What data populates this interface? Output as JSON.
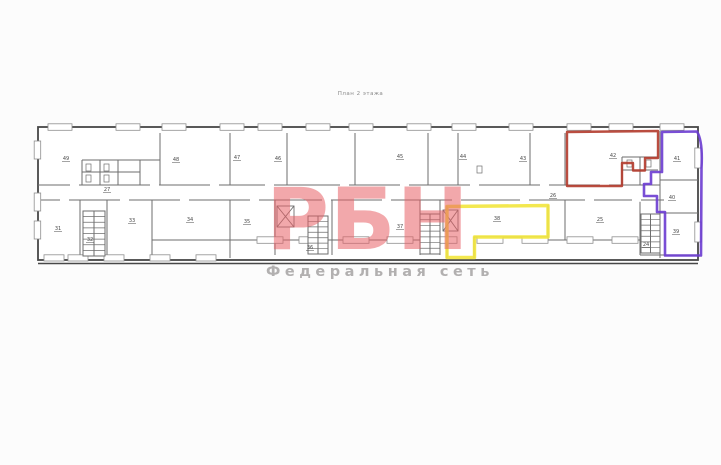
{
  "title": "План 2 этажа",
  "watermark": {
    "logo": "РБН",
    "tagline": "Федеральная сеть",
    "logo_color": "rgba(232,96,102,0.55)",
    "tagline_color": "#b2b0b0"
  },
  "colors": {
    "wall": "#474747",
    "wall_light": "#6e6e6e",
    "red_outline": "#b23a2b",
    "purple_outline": "#6a3bd0",
    "yellow_outline": "#f2e53c",
    "paper": "#ffffff"
  },
  "plan": {
    "room_labels": [
      {
        "t": "49",
        "x": 66,
        "y": 160
      },
      {
        "t": "48",
        "x": 176,
        "y": 161
      },
      {
        "t": "47",
        "x": 237,
        "y": 159
      },
      {
        "t": "46",
        "x": 278,
        "y": 160
      },
      {
        "t": "45",
        "x": 400,
        "y": 158
      },
      {
        "t": "44",
        "x": 463,
        "y": 158
      },
      {
        "t": "43",
        "x": 523,
        "y": 160
      },
      {
        "t": "42",
        "x": 613,
        "y": 157
      },
      {
        "t": "41",
        "x": 677,
        "y": 160
      },
      {
        "t": "40",
        "x": 672,
        "y": 199
      },
      {
        "t": "39",
        "x": 676,
        "y": 233
      },
      {
        "t": "27",
        "x": 107,
        "y": 191
      },
      {
        "t": "26",
        "x": 553,
        "y": 197
      },
      {
        "t": "31",
        "x": 58,
        "y": 230
      },
      {
        "t": "32",
        "x": 90,
        "y": 241
      },
      {
        "t": "33",
        "x": 132,
        "y": 222
      },
      {
        "t": "34",
        "x": 190,
        "y": 221
      },
      {
        "t": "35",
        "x": 247,
        "y": 223
      },
      {
        "t": "36",
        "x": 310,
        "y": 249
      },
      {
        "t": "37",
        "x": 400,
        "y": 228
      },
      {
        "t": "38",
        "x": 497,
        "y": 220
      },
      {
        "t": "25",
        "x": 600,
        "y": 221
      },
      {
        "t": "24",
        "x": 646,
        "y": 246
      }
    ],
    "windows": [
      [
        48,
        123.8,
        24,
        6.5
      ],
      [
        116,
        123.8,
        24,
        6.5
      ],
      [
        162,
        123.8,
        24,
        6.5
      ],
      [
        220,
        123.8,
        24,
        6.5
      ],
      [
        258,
        123.8,
        24,
        6.5
      ],
      [
        306,
        123.8,
        24,
        6.5
      ],
      [
        349,
        123.8,
        24,
        6.5
      ],
      [
        407,
        123.8,
        24,
        6.5
      ],
      [
        452,
        123.8,
        24,
        6.5
      ],
      [
        509,
        123.8,
        24,
        6.5
      ],
      [
        567,
        123.8,
        24,
        6.5
      ],
      [
        609,
        123.8,
        24,
        6.5
      ],
      [
        660,
        123.8,
        24,
        6.5
      ],
      [
        257,
        236.8,
        26,
        6.5
      ],
      [
        299,
        236.8,
        26,
        6.5
      ],
      [
        343,
        236.8,
        26,
        6.5
      ],
      [
        387,
        236.8,
        26,
        6.5
      ],
      [
        431,
        236.8,
        26,
        6.5
      ],
      [
        477,
        236.8,
        26,
        6.5
      ],
      [
        522,
        236.8,
        26,
        6.5
      ],
      [
        567,
        236.8,
        26,
        6.5
      ],
      [
        612,
        236.8,
        26,
        6.5
      ],
      [
        44,
        254.8,
        20,
        6.2
      ],
      [
        68,
        254.8,
        20,
        6.2
      ],
      [
        104,
        254.8,
        20,
        6.2
      ],
      [
        150,
        254.8,
        20,
        6.2
      ],
      [
        196,
        254.8,
        20,
        6.2
      ],
      [
        34.2,
        141,
        6.5,
        18
      ],
      [
        34.2,
        193,
        6.5,
        18
      ],
      [
        34.2,
        221,
        6.5,
        18
      ],
      [
        694.8,
        148,
        6.5,
        20
      ],
      [
        694.8,
        222,
        6.5,
        20
      ]
    ],
    "door_gaps": [
      [
        70,
        183.2
      ],
      [
        150,
        183.2
      ],
      [
        210,
        183.2
      ],
      [
        265,
        183.2
      ],
      [
        340,
        183.2
      ],
      [
        400,
        183.2
      ],
      [
        470,
        183.2
      ],
      [
        540,
        183.2
      ],
      [
        600,
        183.2
      ],
      [
        60,
        198.2
      ],
      [
        120,
        198.2
      ],
      [
        180,
        198.2
      ],
      [
        250,
        198.2
      ],
      [
        322,
        198.2
      ],
      [
        382,
        198.2
      ],
      [
        452,
        198.2
      ],
      [
        520,
        198.2
      ],
      [
        585,
        198.2
      ],
      [
        632,
        198.2
      ]
    ],
    "stairs": [
      {
        "x": 83,
        "y": 211,
        "w": 22,
        "h": 45,
        "n": 8
      },
      {
        "x": 308,
        "y": 216,
        "w": 20,
        "h": 38,
        "n": 7
      },
      {
        "x": 420,
        "y": 214,
        "w": 20,
        "h": 40,
        "n": 7
      },
      {
        "x": 641,
        "y": 214,
        "w": 19,
        "h": 39,
        "n": 7
      }
    ],
    "elevators": [
      {
        "x": 277,
        "y": 206,
        "w": 17,
        "h": 21
      },
      {
        "x": 443,
        "y": 210,
        "w": 15,
        "h": 21
      }
    ],
    "fixtures": [
      [
        86,
        164
      ],
      [
        104,
        164
      ],
      [
        86,
        175
      ],
      [
        104,
        175
      ],
      [
        627,
        160
      ],
      [
        646,
        160
      ],
      [
        477,
        166
      ]
    ],
    "overlays": {
      "red_path": "M567,132 L658,131 L658,158 L645,158 L645,170.5 L633,170.5 L633,163 L622,163 L622,186 L567,186 Z",
      "purple_path": "M662,132 L697,131.5 C701,138 702.5,150 701.5,168 L701,255.5 L665,255.5 L665,212 L657,212 L657,196 L644,196 L644,184 L651,184 L651,172 L662,172 Z",
      "yellow_path": "M447,206.5 L548,205.5 L548,237 L474.5,237 L474.5,257.5 L447,257.5 Z"
    }
  }
}
